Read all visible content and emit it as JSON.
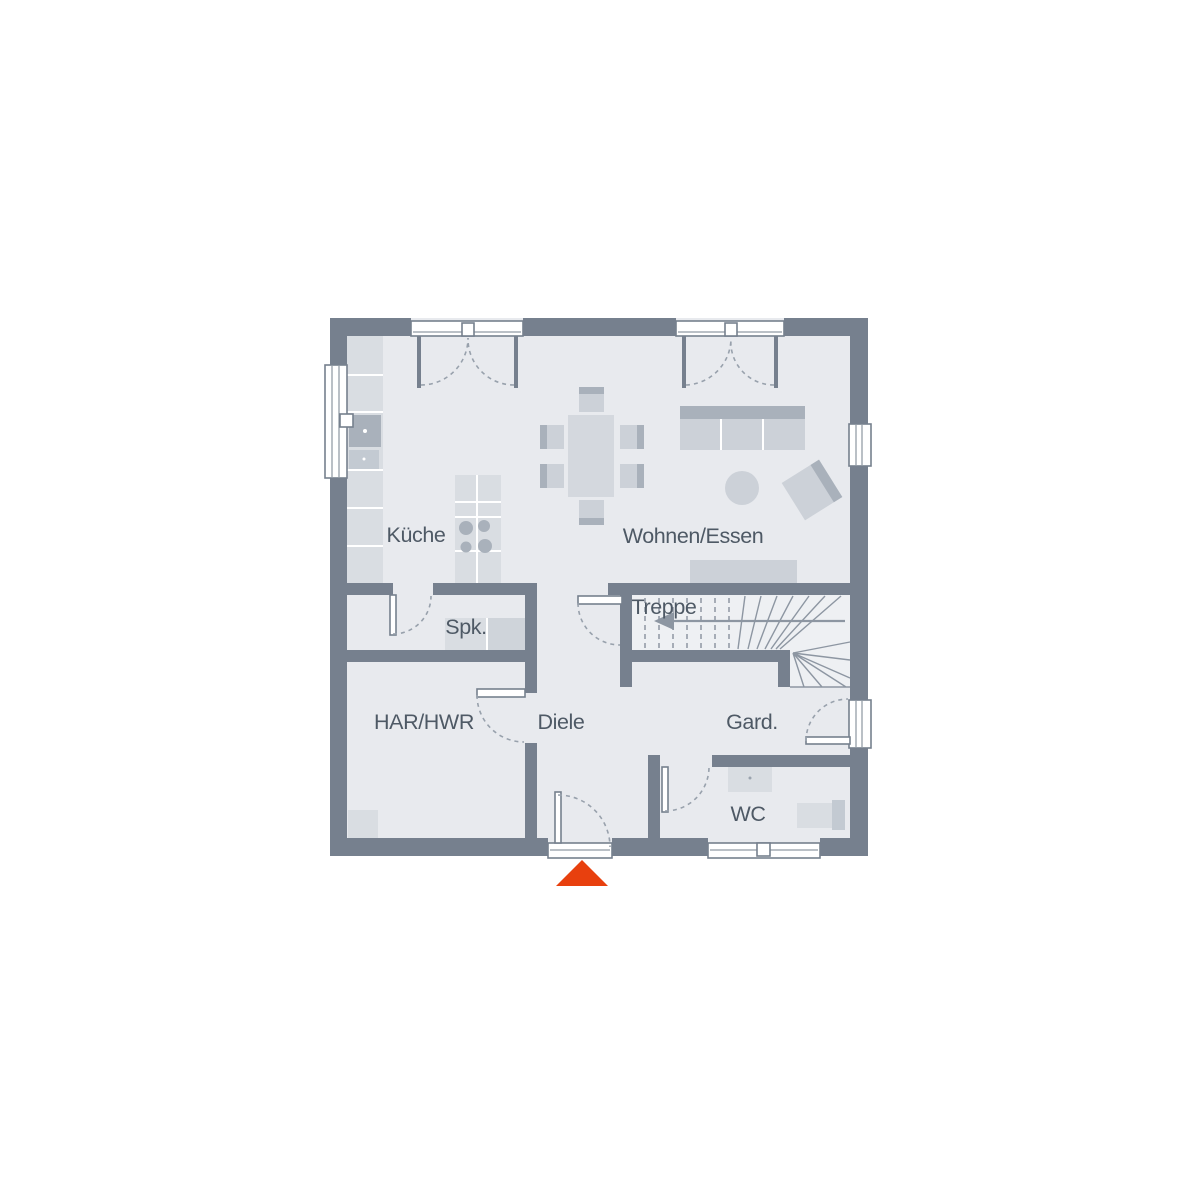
{
  "rooms": [
    {
      "id": "kueche",
      "label": "Küche"
    },
    {
      "id": "wohnen-essen",
      "label": "Wohnen/Essen"
    },
    {
      "id": "spk",
      "label": "Spk."
    },
    {
      "id": "treppe",
      "label": "Treppe"
    },
    {
      "id": "har-hwr",
      "label": "HAR/HWR"
    },
    {
      "id": "diele",
      "label": "Diele"
    },
    {
      "id": "gard",
      "label": "Gard."
    },
    {
      "id": "wc",
      "label": "WC"
    }
  ],
  "icons": {
    "entrance_marker": "triangle-up",
    "stairs_direction": "arrow-left"
  },
  "colors": {
    "wall": "#76808e",
    "floor": "#e8eaee",
    "furniture_light": "#d9dde2",
    "furniture_mid": "#ccd1d8",
    "furniture_dark": "#a9b1bb",
    "label_text": "#4e5965",
    "entrance_marker": "#e8400e"
  }
}
